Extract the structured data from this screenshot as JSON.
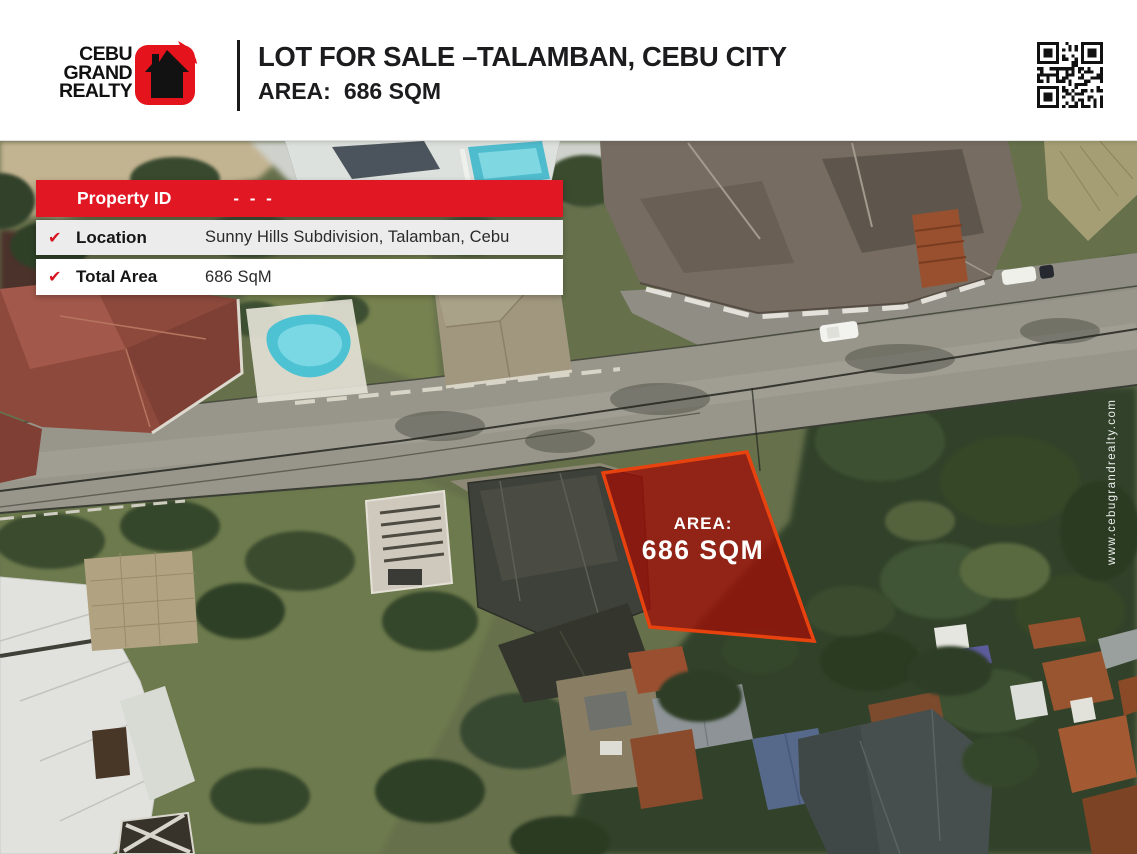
{
  "header": {
    "logo": {
      "line1": "CEBU",
      "line2": "GRAND",
      "line3": "REALTY"
    },
    "title_line1": "LOT FOR SALE –TALAMBAN, CEBU CITY",
    "title_line2_label": "AREA:",
    "title_line2_value": "686 SQM"
  },
  "info_box": {
    "header_label": "Property ID",
    "header_value": "- - -",
    "check_glyph": "✔",
    "rows": [
      {
        "label": "Location",
        "value": "Sunny Hills Subdivision, Talamban, Cebu"
      },
      {
        "label": "Total Area",
        "value": "686 SqM"
      }
    ]
  },
  "map": {
    "lot_area_label": "AREA:",
    "lot_area_value": "686 SQM",
    "watermark": "www.cebugrandrealty.com"
  },
  "colors": {
    "brand_red": "#e4131c",
    "info_red": "#e11723",
    "check_red": "#d6131f",
    "lot_fill": "#9e1008",
    "lot_stroke": "#e8430e"
  }
}
